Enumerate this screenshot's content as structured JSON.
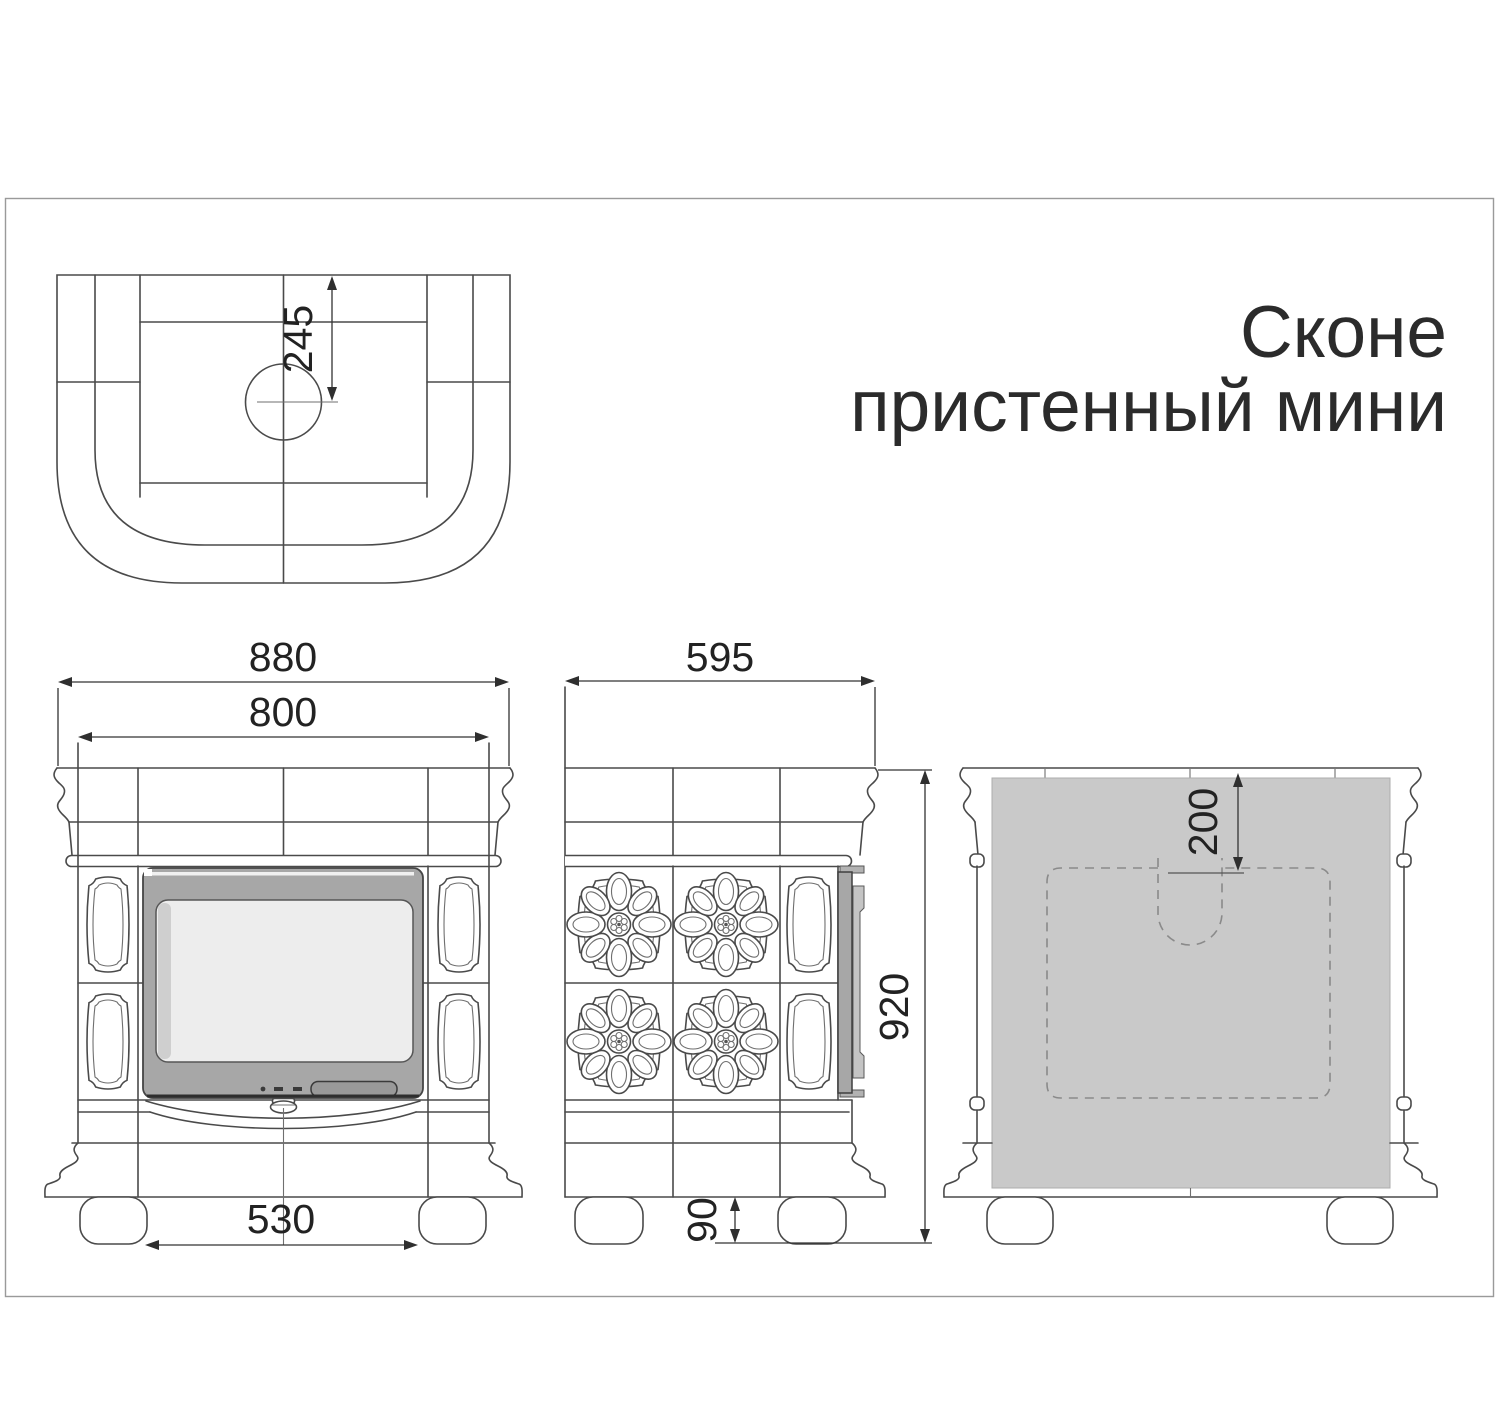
{
  "title": {
    "line1": "Сконе",
    "line2": "пристенный мини"
  },
  "dimensions": {
    "top_view_flue_offset": "245",
    "front_overall_width": "880",
    "front_body_width": "800",
    "front_feet_spacing": "530",
    "side_depth": "595",
    "overall_height": "920",
    "foot_height": "90",
    "back_flue_offset": "200"
  },
  "colors": {
    "door_frame": "#a7a7a7",
    "door_glass": "#ededed",
    "door_bevel": "#cfcfcf",
    "door_handle": "#999999",
    "side_door_bar": "#a7a7a7",
    "side_door_strip": "#c4c4c4",
    "back_panel": "#c9c9c9",
    "drawing_line": "#4a4a4a",
    "dimension_line": "#333333",
    "dashed_line": "#8a8a8a",
    "text": "#2b2b2b",
    "frame_border": "#9a9a9a"
  }
}
